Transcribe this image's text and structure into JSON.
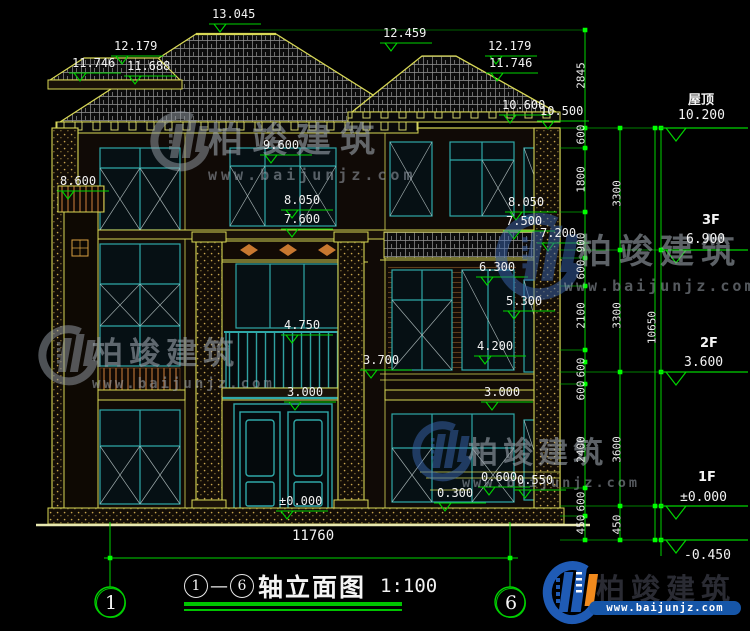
{
  "drawing": {
    "type": "building-elevation",
    "colors": {
      "background": "#000000",
      "dim_green": "#00d400",
      "bright_green": "#00ff00",
      "outline_yellow": "#d8d855",
      "window_teal": "#2fa8a8",
      "text_white": "#f2f2f2",
      "wood_brown": "#8a5526",
      "brand_blue": "#1f5bb5",
      "brand_orange": "#f18a1d"
    }
  },
  "marks": [
    {
      "v": "13.045"
    },
    {
      "v": "12.459"
    },
    {
      "v": "12.179"
    },
    {
      "v": "11.746"
    },
    {
      "v": "11.688"
    },
    {
      "v": "12.179"
    },
    {
      "v": "11.746"
    },
    {
      "v": "10.600"
    },
    {
      "v": "10.500"
    },
    {
      "v": "8.600"
    },
    {
      "v": "9.600"
    },
    {
      "v": "8.050"
    },
    {
      "v": "7.600"
    },
    {
      "v": "8.050"
    },
    {
      "v": "7.500"
    },
    {
      "v": "7.200"
    },
    {
      "v": "6.300"
    },
    {
      "v": "5.300"
    },
    {
      "v": "4.750"
    },
    {
      "v": "4.200"
    },
    {
      "v": "3.700"
    },
    {
      "v": "3.000"
    },
    {
      "v": "3.000"
    },
    {
      "v": "0.600"
    },
    {
      "v": "0.550"
    },
    {
      "v": "0.300"
    },
    {
      "v": "±0.000"
    }
  ],
  "levels": [
    {
      "label": "屋顶",
      "value": "10.200"
    },
    {
      "label": "3F",
      "value": "6.900"
    },
    {
      "label": "2F",
      "value": "3.600"
    },
    {
      "label": "1F",
      "value": "±0.000"
    },
    {
      "label": "",
      "value": "-0.450"
    }
  ],
  "dims": {
    "tier1": [
      "2845",
      "600",
      "1800",
      "900",
      "600",
      "2100",
      "600",
      "600",
      "2400",
      "600",
      "450"
    ],
    "tier2": [
      "3300",
      "3300",
      "3600",
      "450"
    ],
    "tier3": [
      "10650"
    ]
  },
  "bottom_dim": {
    "total_width": "11760"
  },
  "axis_bubbles": {
    "left": "1",
    "right": "6"
  },
  "title_block": {
    "axis_start": "1",
    "dash": "—",
    "axis_end": "6",
    "name": "轴立面图",
    "scale": "1:100"
  },
  "watermark": {
    "brand": "柏竣建筑",
    "url": "www.baijunjz.com"
  },
  "footer_brand": {
    "name": "柏竣建筑",
    "url": "www.baijunjz.com"
  }
}
